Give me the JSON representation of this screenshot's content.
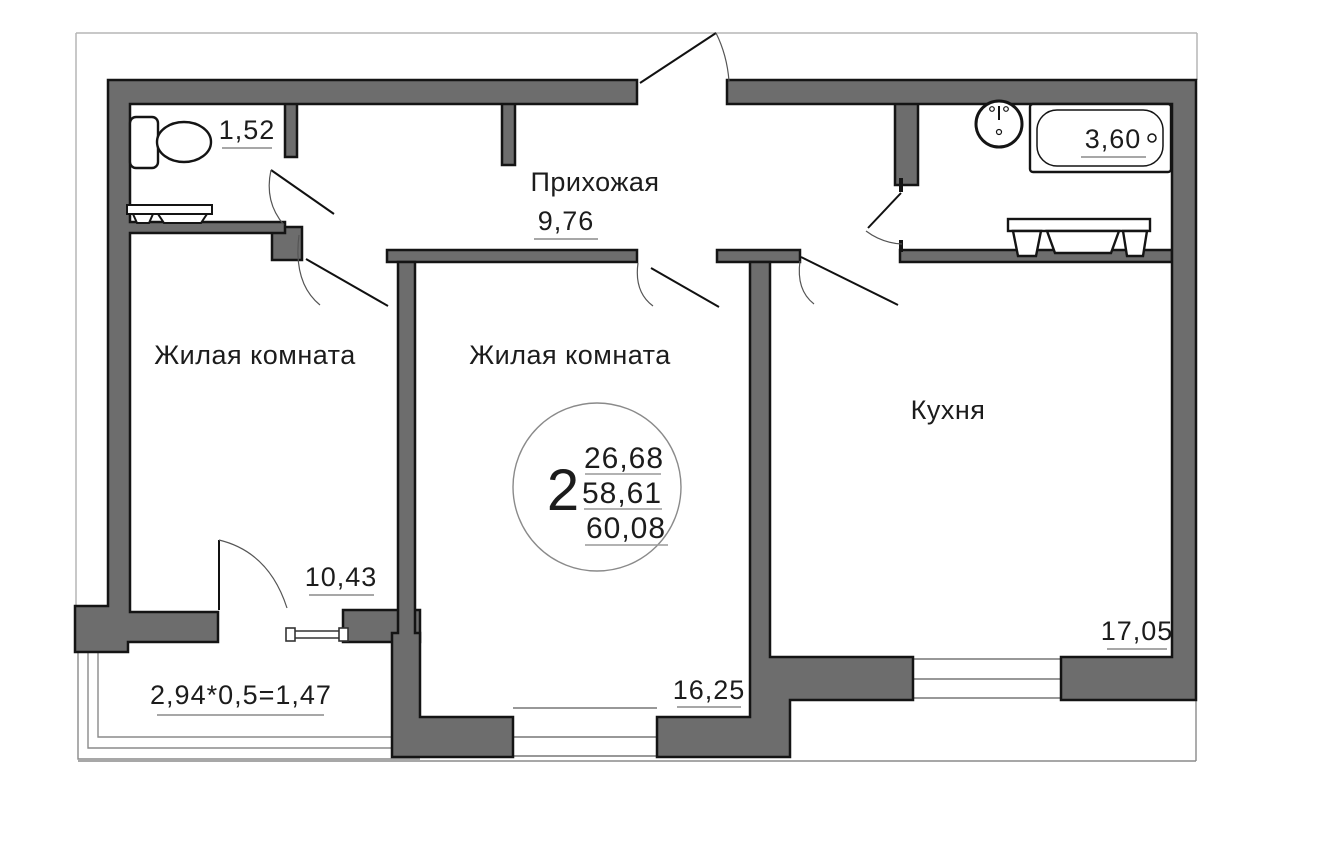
{
  "plan": {
    "stamp": {
      "rooms": "2",
      "living_area": "26,68",
      "apartment_area": "58,61",
      "total_area": "60,08"
    },
    "rooms": {
      "wc": {
        "area": "1,52"
      },
      "hallway": {
        "name": "Прихожая",
        "area": "9,76"
      },
      "bathroom": {
        "area": "3,60"
      },
      "living1": {
        "name": "Жилая комната",
        "area": "10,43"
      },
      "living2": {
        "name": "Жилая комната",
        "area": "16,25"
      },
      "kitchen": {
        "name": "Кухня",
        "area": "17,05"
      },
      "balcony": {
        "calc": "2,94*0,5=1,47"
      }
    },
    "colors": {
      "wall_fill": "#6d6d6d",
      "wall_outline": "#141414",
      "thin_line": "#8a8a8a"
    }
  }
}
